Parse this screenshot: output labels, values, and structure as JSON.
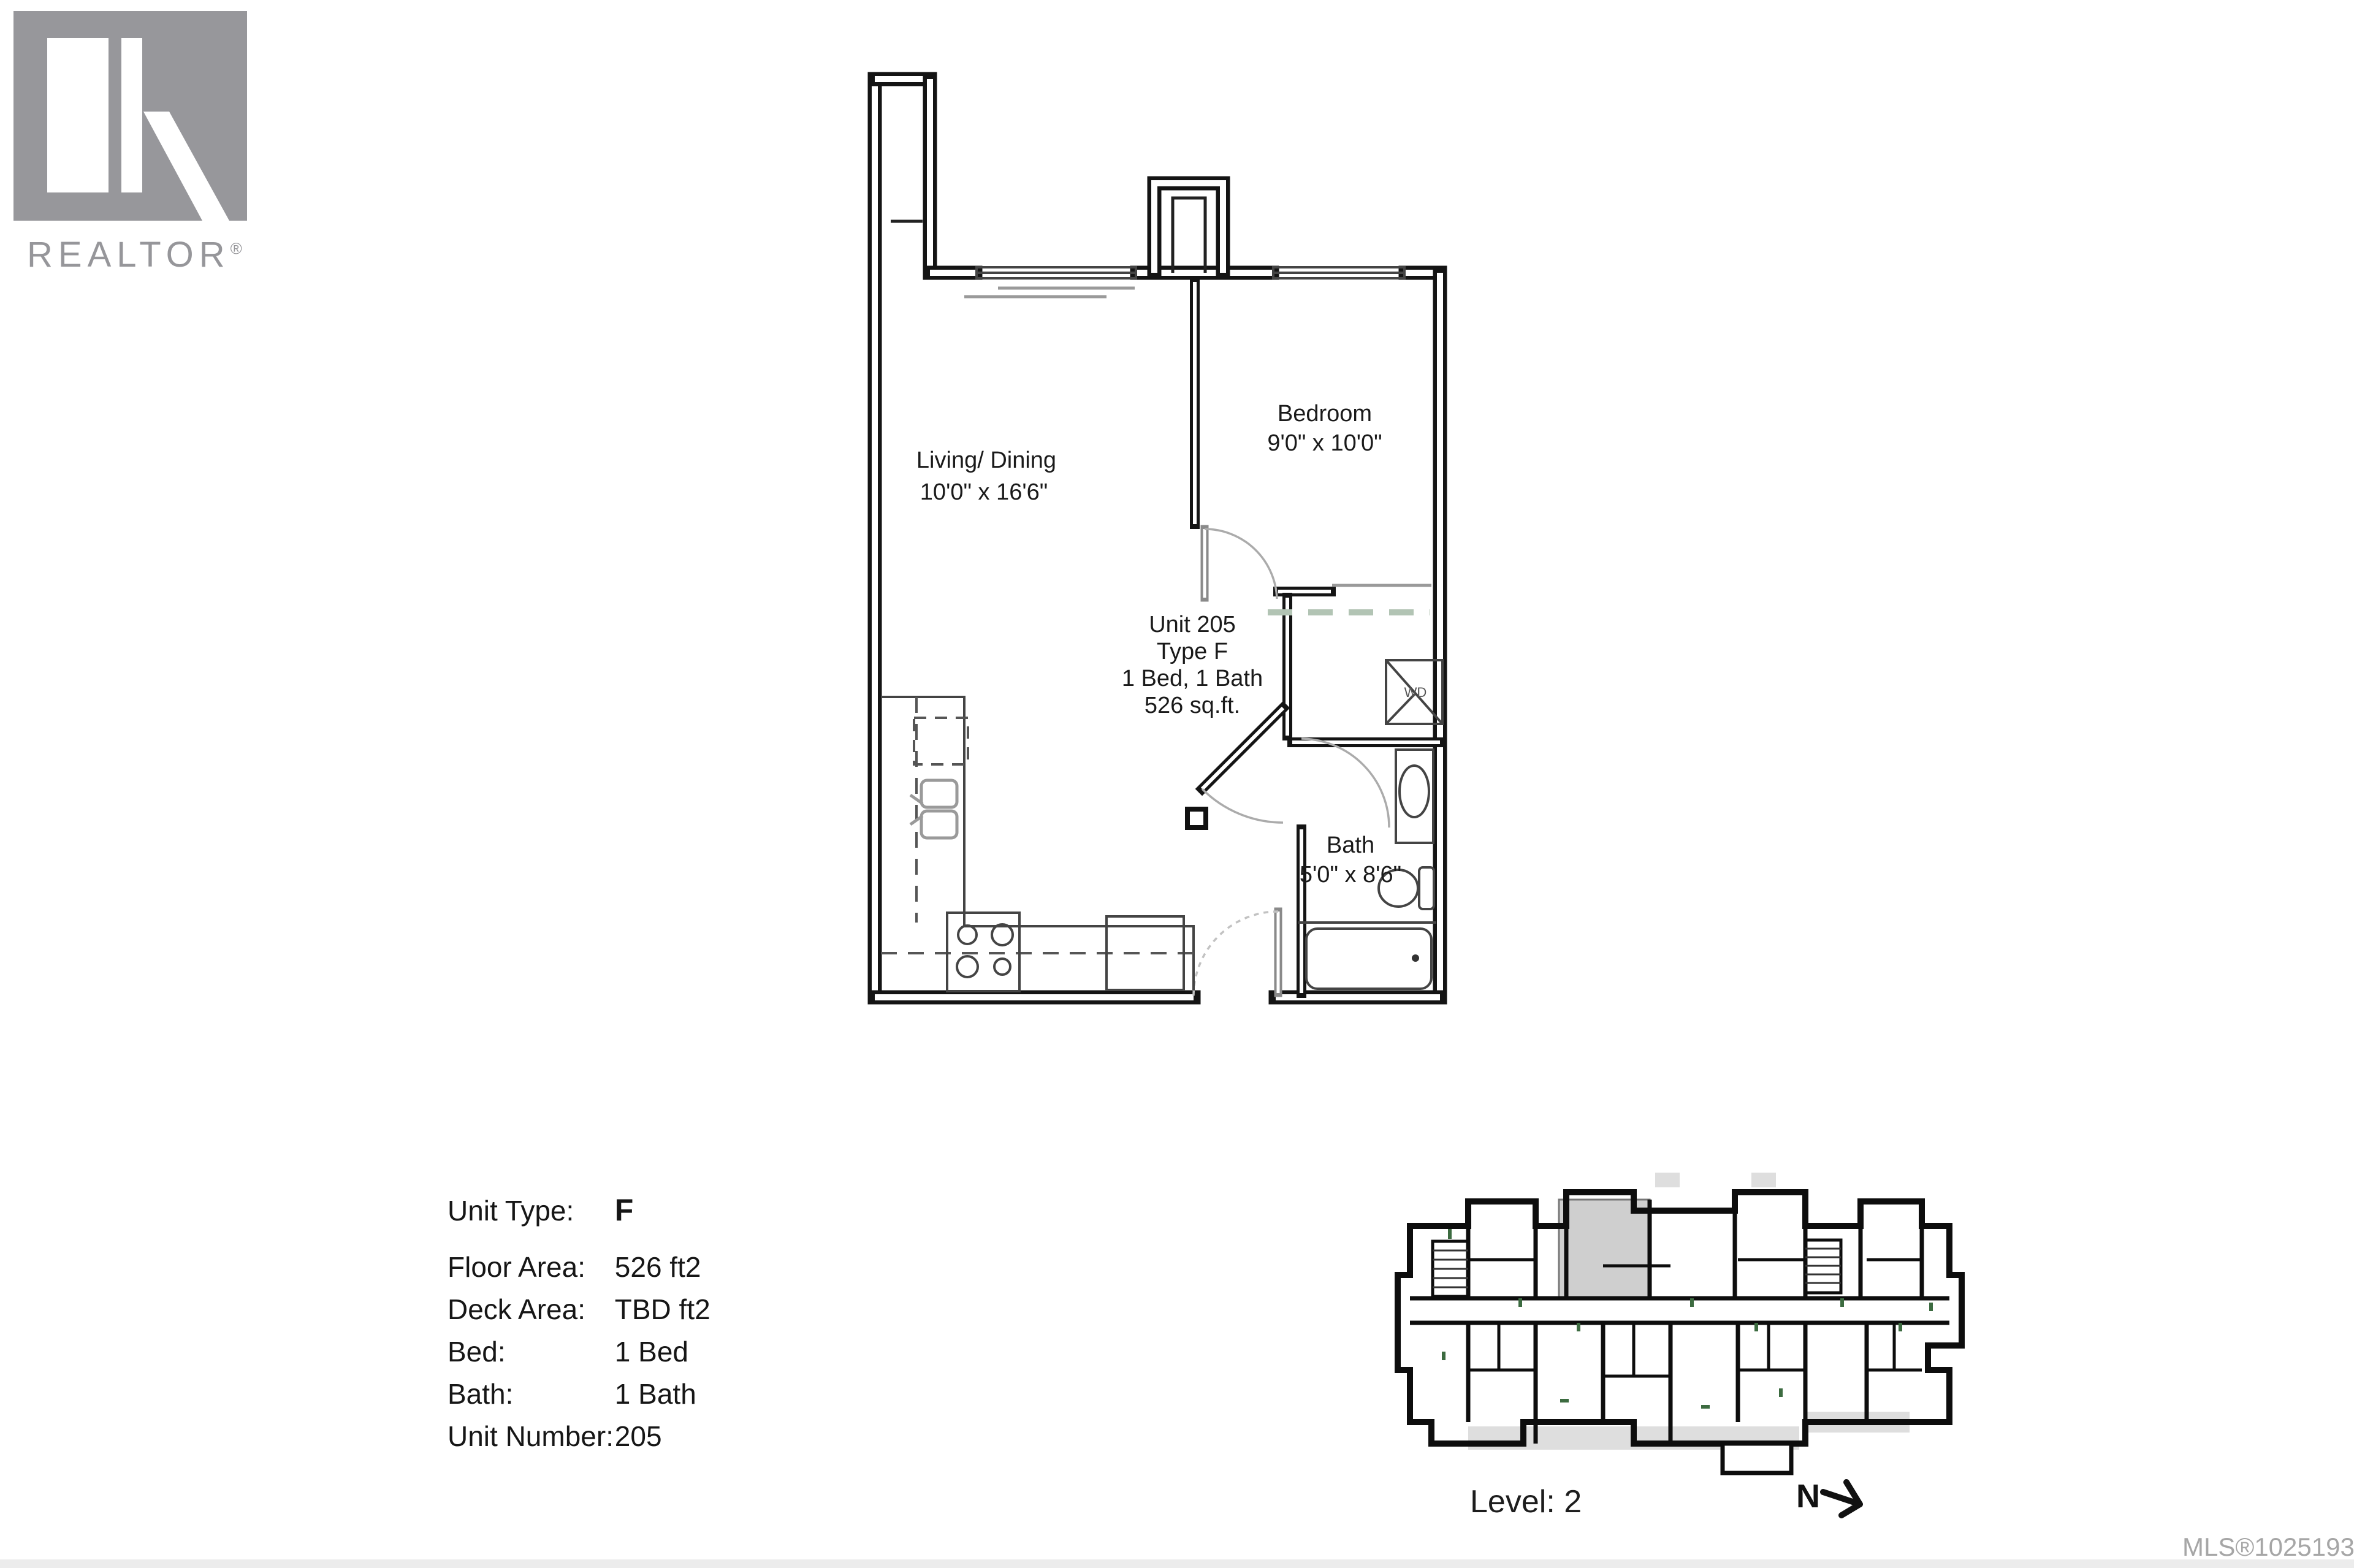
{
  "branding": {
    "logo_text": "REALTOR",
    "registered_mark": "®"
  },
  "floor_plan": {
    "living": {
      "name": "Living/ Dining",
      "dims": "10'0\" x 16'6\""
    },
    "bedroom": {
      "name": "Bedroom",
      "dims": "9'0\" x 10'0\""
    },
    "bath": {
      "name": "Bath",
      "dims": "5'0\" x 8'6\""
    },
    "unit_label": {
      "line1": "Unit 205",
      "line2": "Type F",
      "line3": "1 Bed, 1 Bath",
      "line4": "526 sq.ft."
    },
    "washer_dryer_label": "WD"
  },
  "info_panel": {
    "rows": [
      {
        "label": "Unit Type:",
        "value": "F"
      },
      {
        "label": "Floor Area:",
        "value": "526 ft2"
      },
      {
        "label": "Deck Area:",
        "value": "TBD ft2"
      },
      {
        "label": "Bed:",
        "value": "1 Bed"
      },
      {
        "label": "Bath:",
        "value": "1 Bath"
      },
      {
        "label": "Unit Number:",
        "value": "205"
      }
    ]
  },
  "key_plan": {
    "level_label": "Level: 2",
    "north_label": "N"
  },
  "footer": {
    "mls_number": "MLS®1025193"
  },
  "colors": {
    "logo_gray": "#97979b",
    "wall_black": "#141414",
    "closet_dash_green": "#b2c4b4",
    "highlight_unit_gray": "#cfcfcf",
    "mls_gray": "#a6a6a6"
  }
}
